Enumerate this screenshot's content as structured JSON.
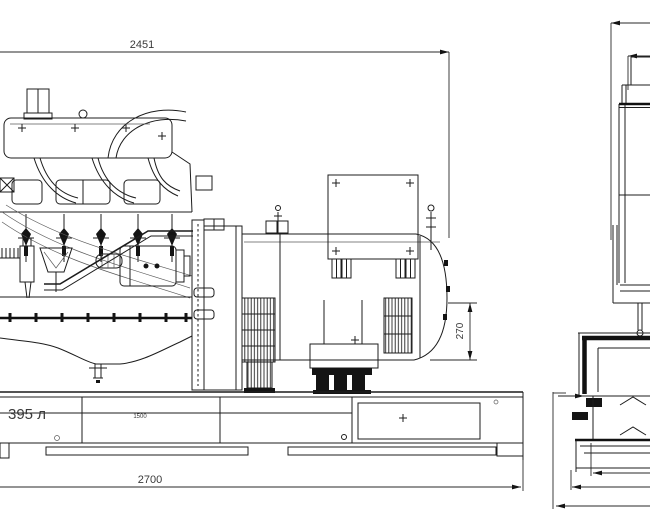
{
  "drawing": {
    "type": "engineering-general-arrangement",
    "subject": "diesel-generator-set",
    "background_color": "#ffffff",
    "line_color": "#1c1c1c",
    "text_color": "#3a3a3a",
    "dims": {
      "overall_length_top": "2451",
      "base_length_bottom": "2700",
      "rear_outlet_height": "270",
      "fuel_tank_capacity": "395 л",
      "tank_panel_width": "1500"
    }
  }
}
